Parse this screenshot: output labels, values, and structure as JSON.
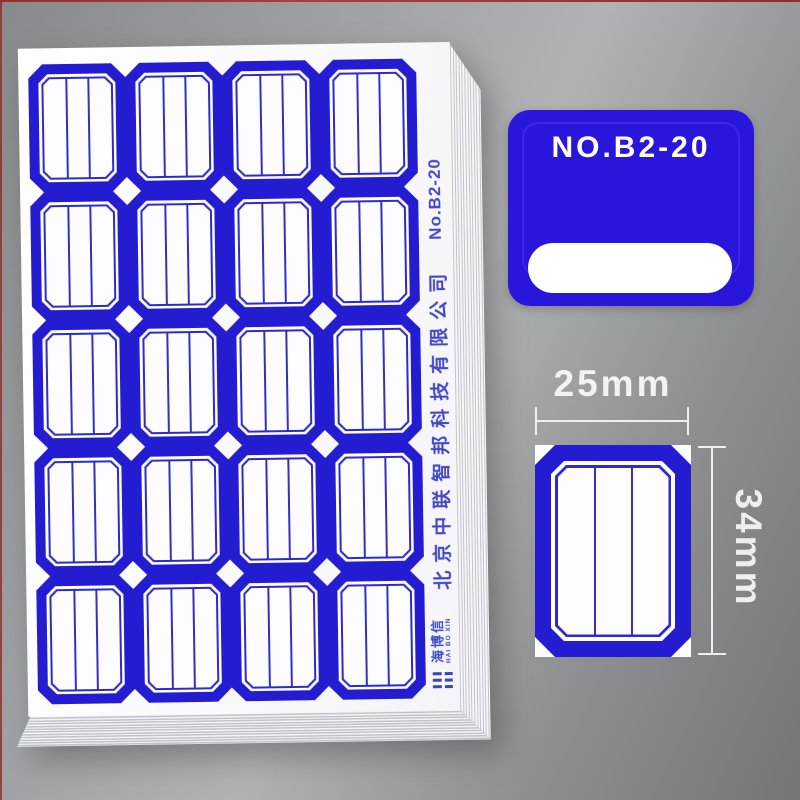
{
  "product": {
    "badge": {
      "title": "NO.B2-20"
    },
    "sheet": {
      "company": "北京中联智邦科技有限公司",
      "model_vertical": "No.B2-20",
      "brand_cn": "海博信",
      "brand_en": "HAI BO XIN",
      "grid": {
        "rows": 5,
        "cols": 4
      }
    },
    "dimensions": {
      "width": "25mm",
      "height": "34mm"
    },
    "colors": {
      "label_blue": "#231cd0",
      "badge_blue": "#2a16da"
    }
  }
}
